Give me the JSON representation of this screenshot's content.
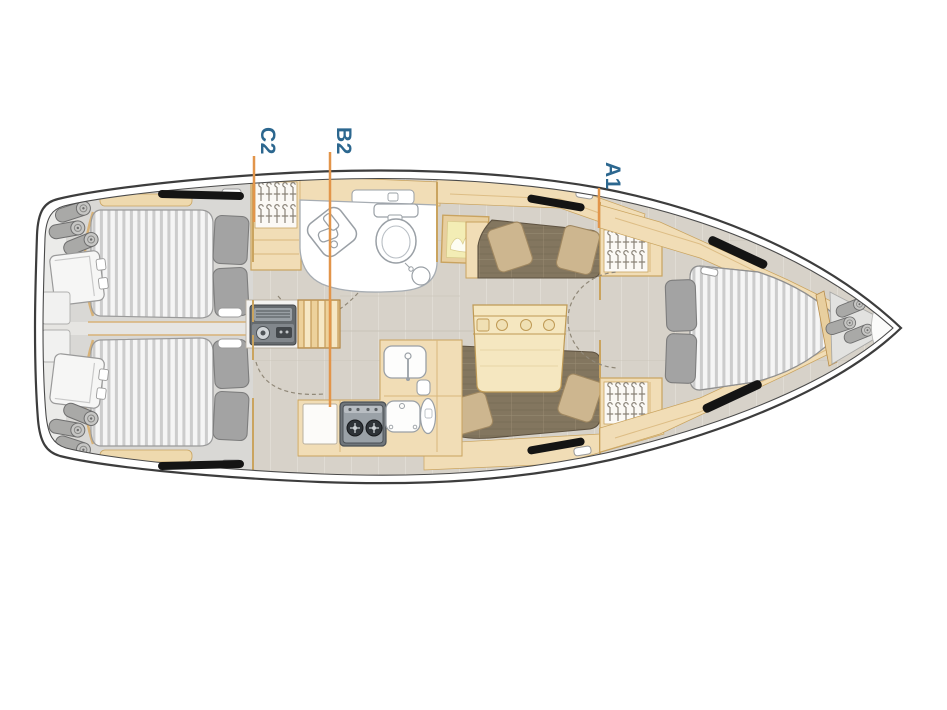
{
  "diagram": {
    "type": "sailing-yacht-interior-floor-plan",
    "orientation": "bow-right",
    "labels": {
      "c2": "C2",
      "b2": "B2",
      "a1": "A1"
    },
    "colors": {
      "label_text": "#2c678f",
      "leader_line": "#e2954a",
      "hull_outline": "#3d3d3d",
      "cabinetry_wood": "#f1ddb6",
      "upholstery": "#83765f",
      "floor": "#d7d2c9",
      "mattress": "#f5f5f5",
      "hull_window": "#141414"
    },
    "areas": [
      "aft-cabin-port",
      "aft-cabin-starboard",
      "stern-lockers",
      "wardrobe",
      "head-bathroom",
      "companionway-steps",
      "engine-unit",
      "galley",
      "salon-settees",
      "salon-table",
      "forward-wardrobes",
      "v-berth-cabin",
      "bow-locker"
    ]
  }
}
